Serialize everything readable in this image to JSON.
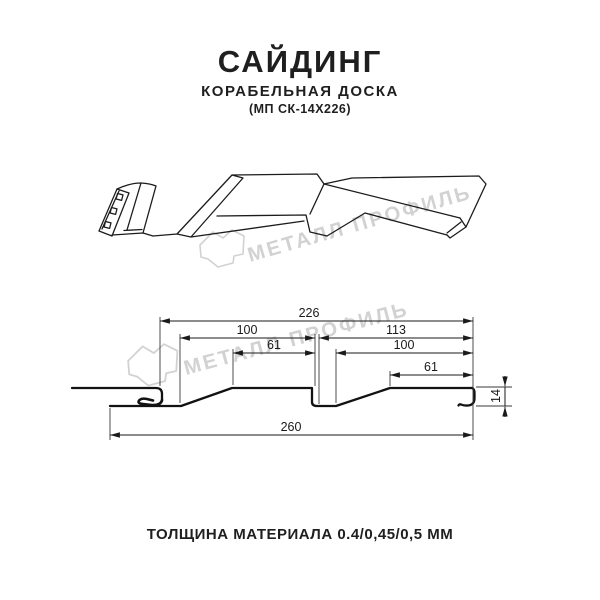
{
  "header": {
    "title": "САЙДИНГ",
    "subtitle": "КОРАБЕЛЬНАЯ ДОСКА",
    "model_code": "(МП СК-14Х226)"
  },
  "watermark": {
    "brand_text": "МЕТАЛЛ ПРОФИЛЬ",
    "color": "#d2d2d2"
  },
  "section_drawing": {
    "dimensions_mm": {
      "cover_width": "226",
      "left_module": "100",
      "right_module": "113",
      "left_flat": "61",
      "right_inner": "100",
      "right_flat": "61",
      "overall_width": "260",
      "height": "14"
    }
  },
  "footer": {
    "thickness_note": "ТОЛЩИНА МАТЕРИАЛА 0.4/0,45/0,5 ММ"
  },
  "colors": {
    "line": "#1a1a1a",
    "text": "#1f1f1f",
    "watermark": "#d2d2d2",
    "background": "#ffffff"
  }
}
